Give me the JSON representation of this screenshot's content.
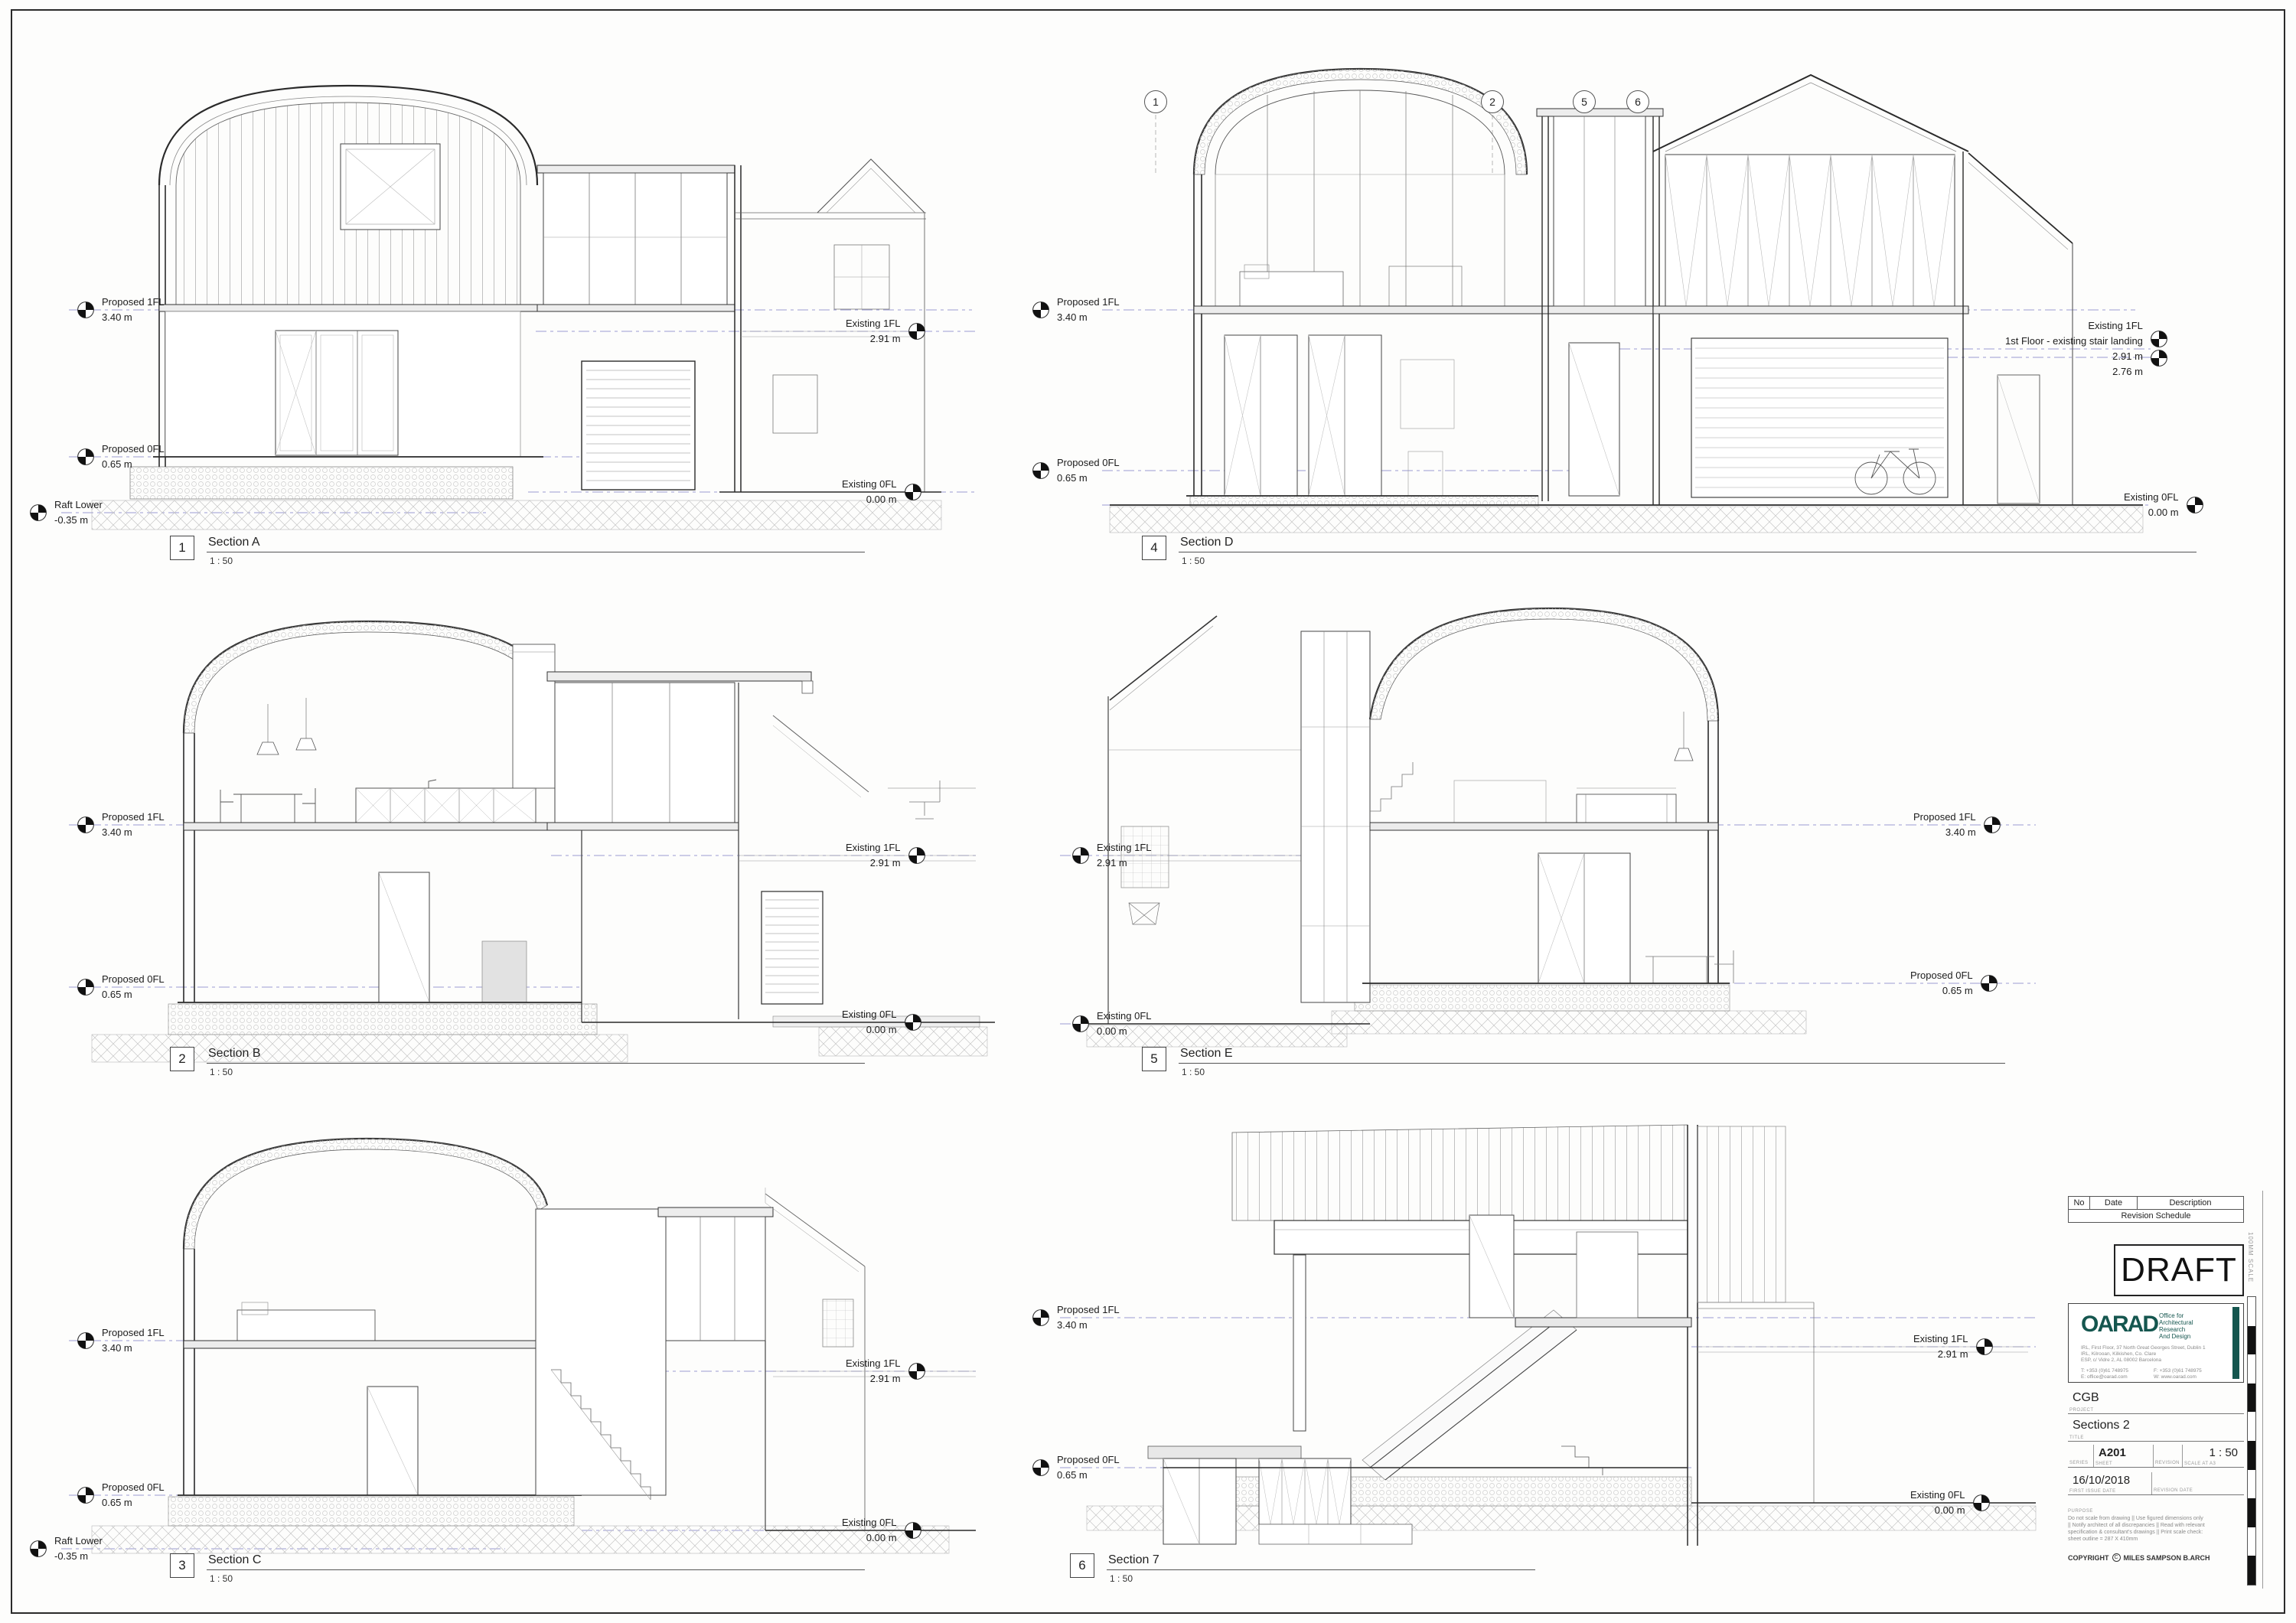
{
  "sheet": {
    "draft": "DRAFT"
  },
  "revision_schedule": {
    "columns": [
      "No",
      "Date",
      "Description"
    ],
    "title": "Revision Schedule"
  },
  "logo": {
    "name": "OARAD",
    "accent_color": "#15564f",
    "tagline_lines": [
      "Office for",
      "Architectural",
      "Research",
      "And Design"
    ],
    "address_lines": [
      "IRL, First Floor, 37 North Great Georges Street, Dublin 1",
      "IRL, Kilrooan, Kilkishen, Co. Clare",
      "ESP, c/ Vidre 2, AL 08002 Barcelona"
    ],
    "contacts": [
      "T:  +353 (0)61 748975",
      "F:  +353 (0)61 748975",
      "E:  office@oarad.com",
      "W:  www.oarad.com"
    ]
  },
  "title_block": {
    "project": {
      "label": "PROJECT",
      "value": "CGB"
    },
    "title": {
      "label": "TITLE",
      "value": "Sections 2"
    },
    "series": {
      "label": "SERIES",
      "value": ""
    },
    "sheet": {
      "label": "SHEET",
      "value": "A201"
    },
    "revision": {
      "label": "REVISION",
      "value": ""
    },
    "scale": {
      "label": "SCALE AT A3",
      "value": "1 : 50"
    },
    "first_issue_date": {
      "label": "FIRST ISSUE DATE",
      "value": "16/10/2018"
    },
    "revision_date": {
      "label": "REVISION DATE",
      "value": ""
    },
    "purpose": {
      "label": "PURPOSE",
      "lines": [
        "Do not scale from drawing || Use figured dimensions only",
        "|| Notify architect of all discrepancies || Read with relevant",
        "specification & consultant's drawings || Print scale check:",
        "sheet outline = 287 X 410mm"
      ]
    },
    "copyright": {
      "pre": "COPYRIGHT",
      "c": "C",
      "name": "MILES SAMPSON B.ARCH"
    },
    "scale_bar_label": "100MM SCALE"
  },
  "sections": [
    {
      "num": "1",
      "title": "Section A",
      "scale": "1 : 50",
      "levels_left": [
        {
          "name": "Proposed 1FL",
          "value": "3.40 m"
        },
        {
          "name": "Proposed 0FL",
          "value": "0.65 m"
        },
        {
          "name": "Raft Lower",
          "value": "-0.35 m"
        }
      ],
      "levels_right": [
        {
          "name": "Existing 1FL",
          "value": "2.91 m"
        },
        {
          "name": "Existing 0FL",
          "value": "0.00 m"
        }
      ]
    },
    {
      "num": "4",
      "title": "Section D",
      "scale": "1 : 50",
      "bubbles": [
        "1",
        "2",
        "5",
        "6"
      ],
      "levels_left": [
        {
          "name": "Proposed 1FL",
          "value": "3.40 m"
        },
        {
          "name": "Proposed 0FL",
          "value": "0.65 m"
        }
      ],
      "levels_right": [
        {
          "name": "Existing 1FL",
          "sub": "1st Floor - existing stair landing",
          "value": "2.91 m",
          "value2": "2.76 m"
        },
        {
          "name": "Existing 0FL",
          "value": "0.00 m"
        }
      ]
    },
    {
      "num": "2",
      "title": "Section B",
      "scale": "1 : 50",
      "levels_left": [
        {
          "name": "Proposed 1FL",
          "value": "3.40 m"
        },
        {
          "name": "Proposed 0FL",
          "value": "0.65 m"
        }
      ],
      "levels_right": [
        {
          "name": "Existing 1FL",
          "value": "2.91 m"
        },
        {
          "name": "Existing 0FL",
          "value": "0.00 m"
        }
      ]
    },
    {
      "num": "5",
      "title": "Section E",
      "scale": "1 : 50",
      "levels_left": [
        {
          "name": "Existing 1FL",
          "value": "2.91 m"
        },
        {
          "name": "Existing 0FL",
          "value": "0.00 m"
        }
      ],
      "levels_right": [
        {
          "name": "Proposed 1FL",
          "value": "3.40 m"
        },
        {
          "name": "Proposed 0FL",
          "value": "0.65 m"
        }
      ]
    },
    {
      "num": "3",
      "title": "Section C",
      "scale": "1 : 50",
      "levels_left": [
        {
          "name": "Proposed 1FL",
          "value": "3.40 m"
        },
        {
          "name": "Proposed 0FL",
          "value": "0.65 m"
        },
        {
          "name": "Raft Lower",
          "value": "-0.35 m"
        }
      ],
      "levels_right": [
        {
          "name": "Existing 1FL",
          "value": "2.91 m"
        },
        {
          "name": "Existing 0FL",
          "value": "0.00 m"
        }
      ]
    },
    {
      "num": "6",
      "title": "Section 7",
      "scale": "1 : 50",
      "levels_left": [
        {
          "name": "Proposed 1FL",
          "value": "3.40 m"
        },
        {
          "name": "Proposed 0FL",
          "value": "0.65 m"
        }
      ],
      "levels_right": [
        {
          "name": "Existing 1FL",
          "value": "2.91 m"
        },
        {
          "name": "Existing 0FL",
          "value": "0.00 m"
        }
      ]
    }
  ]
}
